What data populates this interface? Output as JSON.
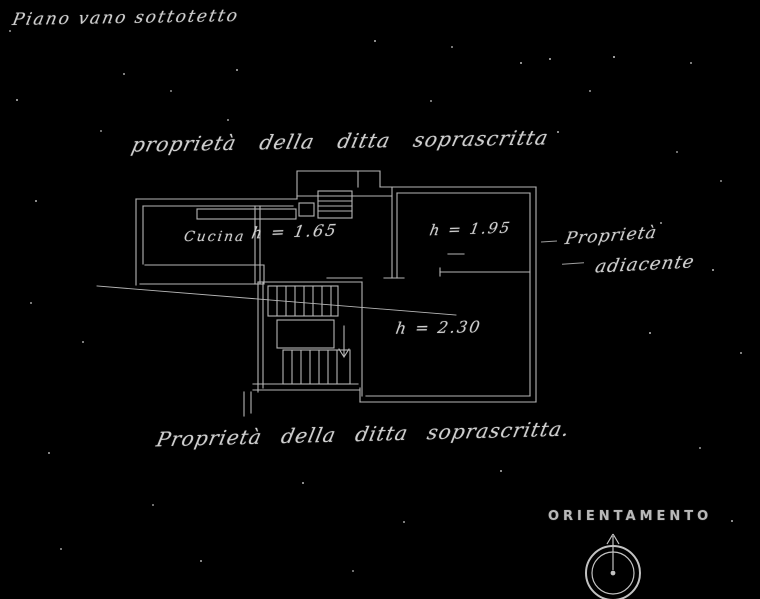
{
  "document": {
    "title": "Piano vano sottotetto",
    "annotations": {
      "top": "proprietà della ditta soprascritta",
      "bottom": "Proprietà della ditta soprascritta.",
      "right_line1": "Proprietà",
      "right_line2": "adiacente"
    },
    "rooms": {
      "kitchen": "Cucina",
      "room_165": "h = 1.65",
      "room_195": "h = 1.95",
      "room_230": "h = 2.30"
    },
    "compass_label": "ORIENTAMENTO",
    "colors": {
      "background": "#000000",
      "ink": "#cfcfcf"
    }
  }
}
